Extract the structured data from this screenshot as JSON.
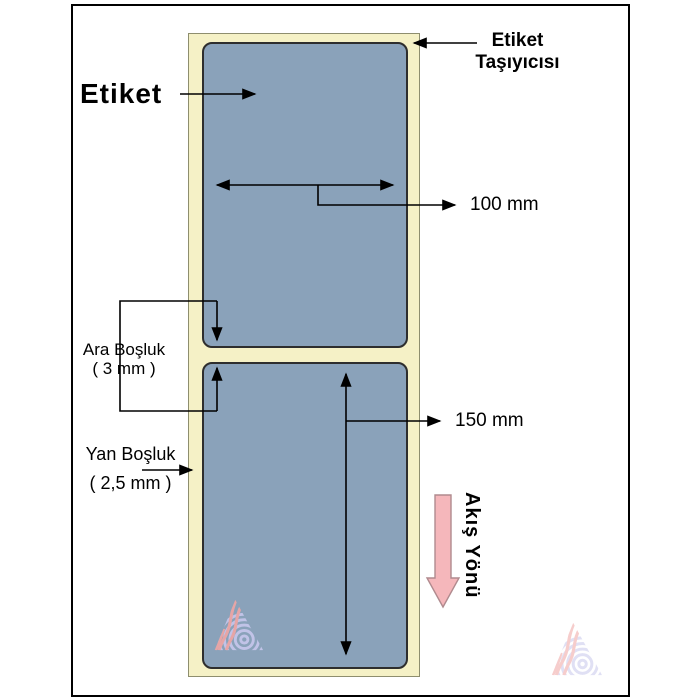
{
  "diagram": {
    "label_callout": "Etiket",
    "carrier_callout": {
      "line1": "Etiket",
      "line2": "Taşıyıcısı"
    },
    "width_dimension": "100 mm",
    "height_dimension": "150 mm",
    "gap_callout": {
      "label": "Ara Boşluk",
      "value": "( 3 mm )"
    },
    "side_margin_callout": {
      "label": "Yan Boşluk",
      "value": "( 2,5 mm )"
    },
    "flow_direction": "Akış Yönü",
    "colors": {
      "carrier_fill": "#f5f1c6",
      "carrier_border": "#8e8e6e",
      "label_fill": "#8aa2ba",
      "label_border": "#2e2e2e",
      "flow_arrow_fill": "#f5b7bb",
      "flow_arrow_border": "#b08a8e",
      "annotation_line": "#000000",
      "watermark_pink": "#f0a6a4",
      "watermark_lavender": "#c7c7ec"
    }
  }
}
